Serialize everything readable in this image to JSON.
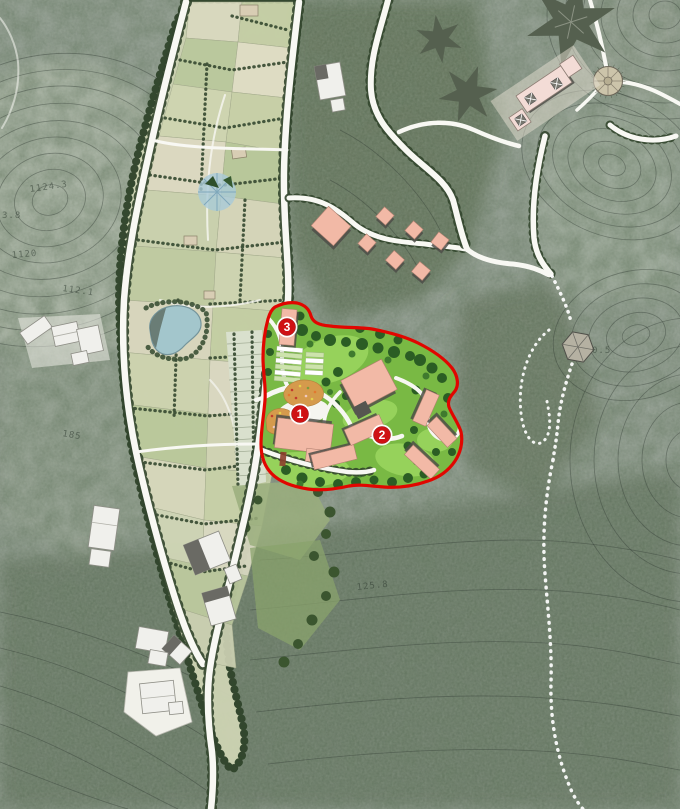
{
  "map": {
    "description": "landscape master plan with red project-site boundary",
    "site": {
      "boundary_color": "#e10600",
      "markers": [
        {
          "label": "1",
          "x": 300,
          "y": 414
        },
        {
          "label": "2",
          "x": 382,
          "y": 435
        },
        {
          "label": "3",
          "x": 287,
          "y": 327
        }
      ]
    },
    "contour_labels": [
      {
        "text": "1124.3",
        "x": 30,
        "y": 192,
        "rot": -8
      },
      {
        "text": "3.8",
        "x": 2,
        "y": 218,
        "rot": 0
      },
      {
        "text": "1120",
        "x": 12,
        "y": 258,
        "rot": -5
      },
      {
        "text": "112.1",
        "x": 62,
        "y": 291,
        "rot": 8
      },
      {
        "text": "185",
        "x": 62,
        "y": 436,
        "rot": 10
      },
      {
        "text": "0.5",
        "x": 592,
        "y": 353,
        "rot": 0
      },
      {
        "text": "125.8",
        "x": 357,
        "y": 590,
        "rot": -6
      }
    ],
    "colors": {
      "boundary-red": "#e10600",
      "marker-red": "#cf1114",
      "building-pink": "#f2b9a6",
      "pale-pink": "#f3dcd6",
      "lawn-green": "#79b944",
      "lawn-light": "#9ad55f",
      "tree-dark": "#2b5d24",
      "forest-base": "#8d998c",
      "field-base": "#ccd2b2",
      "water-blue": "#a3c6cc",
      "road-white": "#f8f8f3",
      "hedge-green": "#3c4f36"
    }
  }
}
